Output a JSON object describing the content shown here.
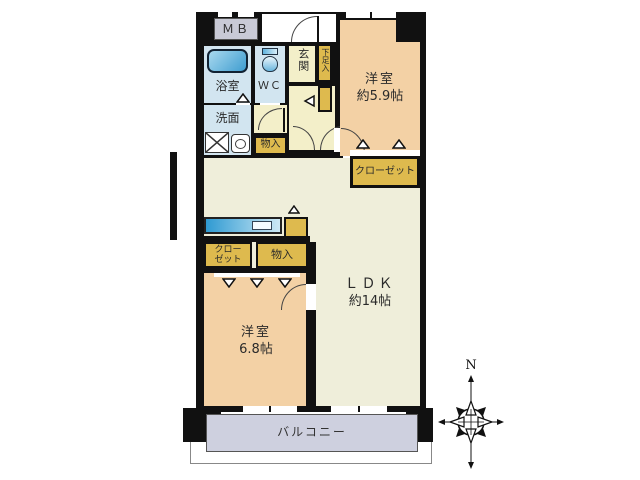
{
  "colors": {
    "wall": "#111111",
    "room_peach": "#f3d1a5",
    "room_cream": "#efeeda",
    "hall_yellow": "#f3efc9",
    "wet_blue": "#d2e5f0",
    "storage_yellow": "#deba4e",
    "mb_gray": "#c9cad6",
    "balcony_lavender": "#ced0df",
    "fixture_blue": "#3f9dd0"
  },
  "labels": {
    "mb": "ＭＢ",
    "bathroom": "浴室",
    "wc": "ＷＣ",
    "genkan": "玄関",
    "shoe_cabinet": "下足入",
    "washroom": "洗面",
    "hall_storage": "物入",
    "bedroom1_name": "洋室",
    "bedroom1_size": "約5.9帖",
    "closet1": "クローゼット",
    "ldk_name": "ＬＤＫ",
    "ldk_size": "約14帖",
    "closet2_line1": "クロー",
    "closet2_line2": "ゼット",
    "storage2": "物入",
    "bedroom2_name": "洋室",
    "bedroom2_size": "6.8帖",
    "balcony": "バルコニー",
    "compass_north": "N"
  }
}
